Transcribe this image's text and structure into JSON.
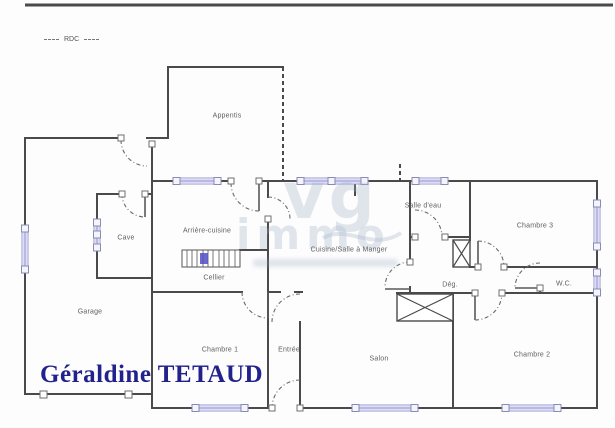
{
  "meta": {
    "floor_label": "RDC",
    "agent_name": "Géraldine TETAUD"
  },
  "watermark": {
    "line1": "vg",
    "line2": "immo"
  },
  "rooms": [
    {
      "id": "appentis",
      "label": "Appentis"
    },
    {
      "id": "cave",
      "label": "Cave"
    },
    {
      "id": "garage",
      "label": "Garage"
    },
    {
      "id": "arriere-cuisine",
      "label": "Arrière-cuisine"
    },
    {
      "id": "cellier",
      "label": "Cellier"
    },
    {
      "id": "chambre-1",
      "label": "Chambre 1"
    },
    {
      "id": "entree",
      "label": "Entrée"
    },
    {
      "id": "salon",
      "label": "Salon"
    },
    {
      "id": "cuisine",
      "label": "Cuisine/Salle à Manger"
    },
    {
      "id": "salle-eau",
      "label": "Salle d'eau"
    },
    {
      "id": "degagement",
      "label": "Dég."
    },
    {
      "id": "wc",
      "label": "W.C."
    },
    {
      "id": "chambre-2",
      "label": "Chambre 2"
    },
    {
      "id": "chambre-3",
      "label": "Chambre 3"
    }
  ],
  "colors": {
    "wall": "#4a4a4a",
    "window": "#b9b9e8",
    "agent_text": "#22228c",
    "watermark": "#a0b0c6",
    "stairs_marker": "#4f4fc8"
  }
}
